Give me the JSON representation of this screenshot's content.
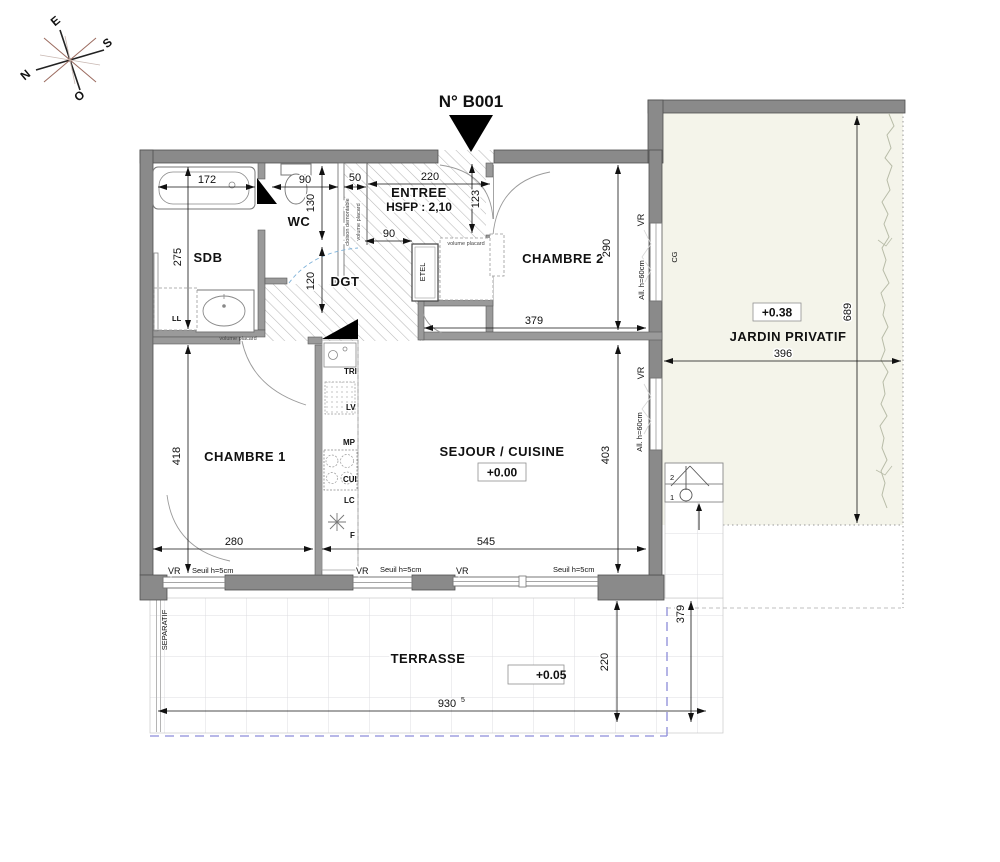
{
  "plan": {
    "unit": "N° B001",
    "compass": {
      "n": "N",
      "e": "E",
      "s": "S",
      "o": "O"
    },
    "rooms": {
      "sdb": "SDB",
      "wc": "WC",
      "entree": "ENTREE",
      "entree_hsfp": "HSFP : 2,10",
      "dgt": "DGT",
      "chambre2": "CHAMBRE 2",
      "chambre1": "CHAMBRE 1",
      "sejour": "SEJOUR / CUISINE",
      "sejour_level": "+0.00",
      "jardin": "JARDIN PRIVATIF",
      "jardin_level": "+0.38",
      "terrasse": "TERRASSE",
      "terrasse_level": "+0.05"
    },
    "dims": {
      "sdb_w": "172",
      "sdb_h": "275",
      "wc_w": "90",
      "wc_h": "130",
      "placard_w": "50",
      "entree_w": "220",
      "entree_d": "123",
      "entree_b": "90",
      "dgt_h": "120",
      "ch2_h": "290",
      "ch2_w": "379",
      "ch1_h": "418",
      "ch1_w": "280",
      "sejour_w": "545",
      "sejour_h": "403",
      "jardin_h": "689",
      "jardin_w": "396",
      "terrasse_w": "930",
      "terrasse_w_sup": "5",
      "terrasse_h": "220",
      "terrasse_side": "379"
    },
    "annotations": {
      "vr": "VR",
      "seuil": "Seuil h=5cm",
      "allege": "All. h=60cm",
      "cg": "CG",
      "ll": "LL",
      "etel": "ETEL",
      "volume_placard": "volume placard",
      "cloison_demontable": "cloison demontable",
      "separatif": "SEPARATIF",
      "tri": "TRI",
      "lv": "LV",
      "mp": "MP",
      "cui": "CUI",
      "lc": "LC",
      "f": "F",
      "step_1": "1",
      "step_2": "2"
    }
  },
  "colors": {
    "wall": "#8a8a8a",
    "hatch": "#b8b8b8",
    "jardin_fill": "#f4f4ea",
    "tile_line": "#dcdce0",
    "parcel_dash_blue": "#8c8cd9",
    "hedge": "#b8bca8",
    "dim": "#111111",
    "swing_blue": "#7fb2d9"
  }
}
